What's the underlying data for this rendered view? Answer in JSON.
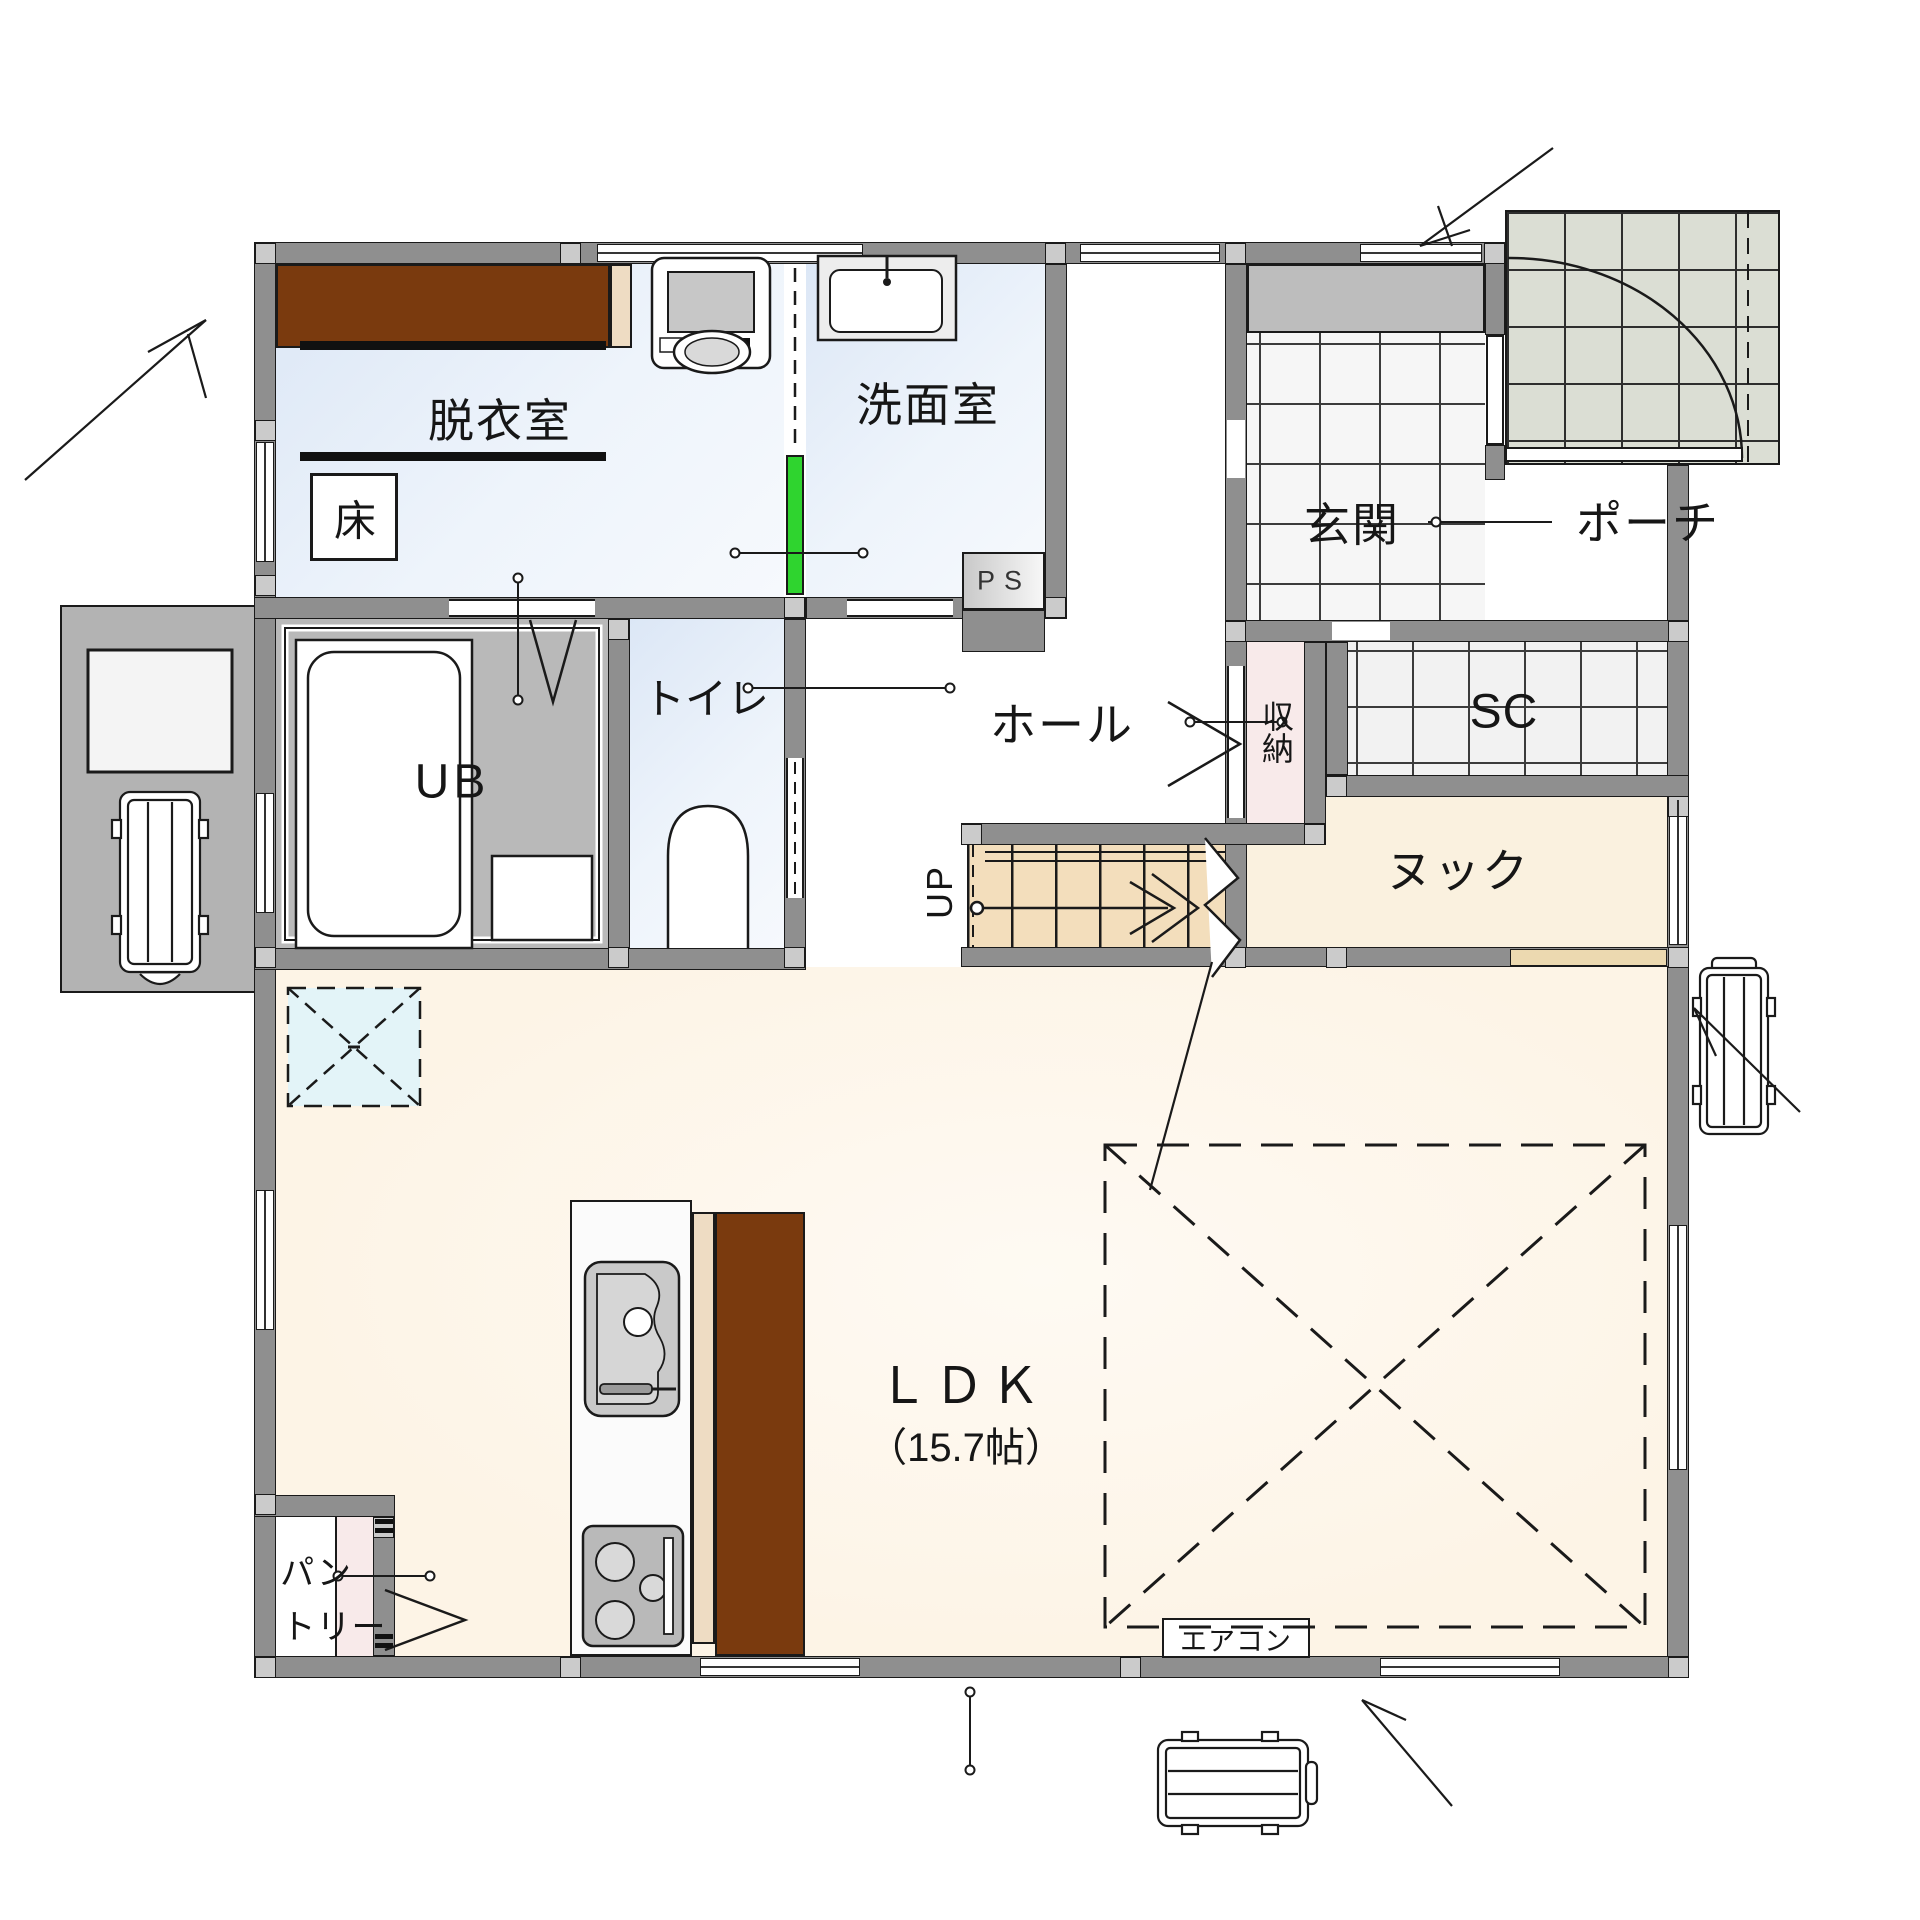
{
  "plan": {
    "title": "1F floor plan",
    "rooms": {
      "datsuishitsu": {
        "label": "脱衣室"
      },
      "floor_box": {
        "label": "床"
      },
      "senmenshitsu": {
        "label": "洗面室"
      },
      "pipe_space": {
        "label": "PS"
      },
      "genkan": {
        "label": "玄関"
      },
      "porch": {
        "label": "ポーチ"
      },
      "hall": {
        "label": "ホール"
      },
      "storage": {
        "label": "収納"
      },
      "shoe_closet": {
        "label": "SC"
      },
      "unit_bath": {
        "label": "UB"
      },
      "toilet": {
        "label": "トイレ"
      },
      "stairs": {
        "label": "UP"
      },
      "nook": {
        "label": "ヌック"
      },
      "ldk": {
        "label": "ＬＤＫ",
        "area": "（15.7帖）"
      },
      "pantry": {
        "line1": "パン",
        "line2": "トリー"
      },
      "aircon": {
        "label": "エアコン"
      }
    },
    "colors": {
      "wall": "#8f8f8f",
      "post": "#cbcbcb",
      "room_blue": "#dce7f6",
      "ldk_cream": "#fdf4e6",
      "nook_cream": "#faf1df",
      "stairs": "#f3debc",
      "closet_pink": "#f8eaea",
      "wood_brown": "#7a3a0e",
      "cabinet_cream": "#eedcc3",
      "door_green": "#2fd42f",
      "porch": "#dbded4",
      "ub_gray": "#b9b9b9",
      "shoe_cabinet": "#bdbdbd",
      "pad_gray": "#b3b3b3"
    }
  }
}
